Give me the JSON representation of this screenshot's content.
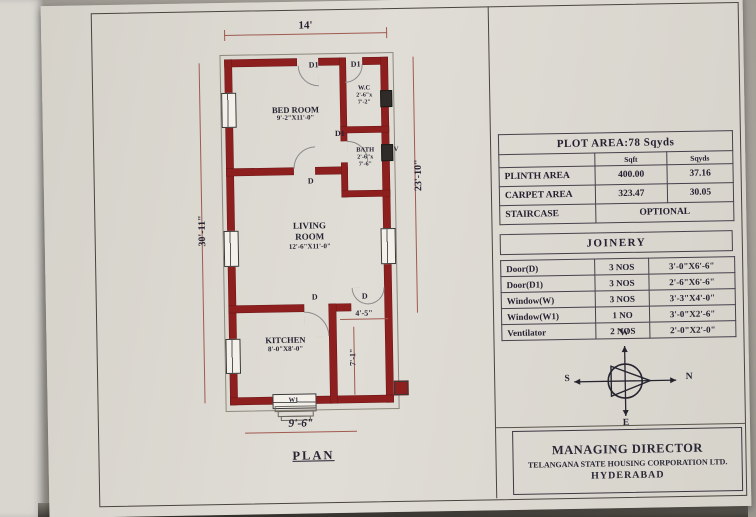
{
  "colors": {
    "wall": "#8e1f1f",
    "paper": "#dcd8cf",
    "dimension_line": "#a05a50"
  },
  "plan": {
    "label": "PLAN",
    "dims": {
      "width_top": "14'",
      "height_left": "30'-11\"",
      "height_right": "23'-10\"",
      "width_bottom": "9'-6\"",
      "sitout_width": "4'-5\"",
      "sitout_height": "7'-1\""
    },
    "rooms": {
      "bedroom": {
        "name": "BED ROOM",
        "size": "9'-2\"X11'-0\""
      },
      "wc": {
        "name": "W.C",
        "size1": "2'-6\"x",
        "size2": "7'-2\""
      },
      "bath": {
        "name": "BATH",
        "size1": "2'-6\"x",
        "size2": "7'-6\""
      },
      "living": {
        "name": "LIVING ROOM",
        "size": "12'-6\"X11'-0\""
      },
      "kitchen": {
        "name": "KITCHEN",
        "size": "8'-0\"X8'-0\""
      }
    },
    "marks": {
      "d1_entrance": "D1",
      "d1_wc": "D1",
      "d1_bath": "D1",
      "d_bedroom": "D",
      "d_kitchen": "D",
      "d_east": "D",
      "w1": "W1",
      "v": "V"
    }
  },
  "area_table": {
    "title": "PLOT AREA:78 Sqyds",
    "col_headers": [
      "Sqft",
      "Sqyds"
    ],
    "rows": [
      {
        "label": "PLINTH AREA",
        "sqft": "400.00",
        "sqyds": "37.16"
      },
      {
        "label": "CARPET AREA",
        "sqft": "323.47",
        "sqyds": "30.05"
      }
    ],
    "staircase_label": "STAIRCASE",
    "staircase_value": "OPTIONAL"
  },
  "joinery_table": {
    "title": "JOINERY",
    "rows": [
      {
        "item": "Door(D)",
        "qty": "3 NOS",
        "size": "3'-0\"X6'-6\""
      },
      {
        "item": "Door(D1)",
        "qty": "3 NOS",
        "size": "2'-6\"X6'-6\""
      },
      {
        "item": "Window(W)",
        "qty": "3 NOS",
        "size": "3'-3\"X4'-0\""
      },
      {
        "item": "Window(W1)",
        "qty": "1 NO",
        "size": "3'-0\"X2'-6\""
      },
      {
        "item": "Ventilator",
        "qty": "2 NOS",
        "size": "2'-0\"X2'-0\""
      }
    ]
  },
  "compass": {
    "top": "W",
    "right": "N",
    "left": "S",
    "bottom": "E"
  },
  "title_block": {
    "line1": "MANAGING DIRECTOR",
    "line2": "TELANGANA STATE HOUSING CORPORATION LTD.",
    "line3": "HYDERABAD"
  }
}
